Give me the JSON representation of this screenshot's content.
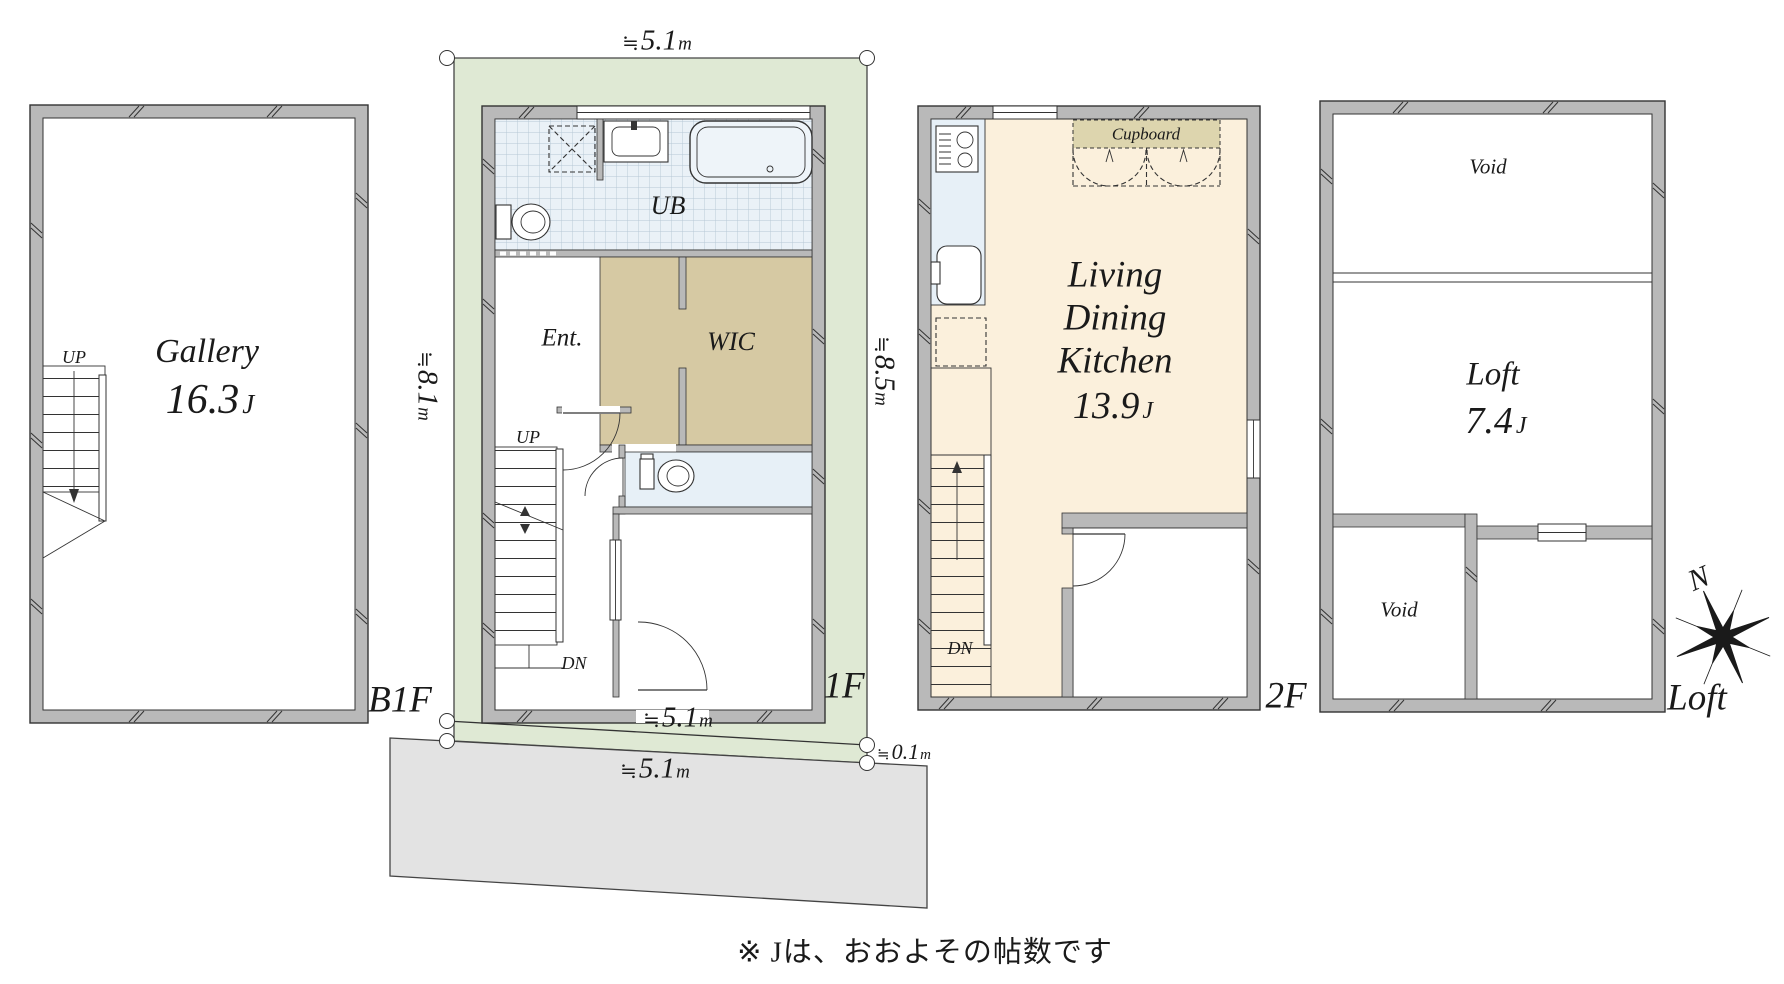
{
  "plans": {
    "b1f": {
      "label": "B1F",
      "room": {
        "name": "Gallery",
        "area_value": "16.3",
        "area_unit": "J"
      },
      "stairs": {
        "up": "UP"
      }
    },
    "f1": {
      "label": "1F",
      "rooms": {
        "bath": "UB",
        "entrance": "Ent.",
        "closet": "WIC"
      },
      "stairs": {
        "up": "UP",
        "down": "DN"
      },
      "dims": {
        "top": {
          "sym": "≒",
          "value": "5.1",
          "unit": "m"
        },
        "left": {
          "sym": "≒",
          "value": "8.1",
          "unit": "m"
        },
        "right": {
          "sym": "≒",
          "value": "8.5",
          "unit": "m"
        },
        "bottom": {
          "sym": "≒",
          "value": "5.1",
          "unit": "m"
        },
        "road": {
          "sym": "≒",
          "value": "5.1",
          "unit": "m"
        },
        "setback": {
          "sym": "≒",
          "value": "0.1",
          "unit": "m"
        }
      }
    },
    "f2": {
      "label": "2F",
      "room": {
        "line1": "Living",
        "line2": "Dining",
        "line3": "Kitchen",
        "area_value": "13.9",
        "area_unit": "J"
      },
      "cupboard_label": "Cupboard",
      "stairs": {
        "down": "DN"
      }
    },
    "loft": {
      "label": "Loft",
      "void_top": "Void",
      "room": {
        "name": "Loft",
        "area_value": "7.4",
        "area_unit": "J"
      },
      "void_bottom": "Void"
    }
  },
  "compass": {
    "north": "N"
  },
  "note": "※ Jは、おおよその帖数です",
  "colors": {
    "site_green": "#dfe9d4",
    "wall_gray": "#b9b9b9",
    "wic_tan": "#d6c9a3",
    "ldk_cream": "#fbf0dc",
    "tile_blue": "#eaf1f7",
    "fixture_blue": "#e7f0f7",
    "cupboard_beige": "#ddd5ae",
    "road_gray": "#e3e3e3",
    "line": "#333333"
  }
}
